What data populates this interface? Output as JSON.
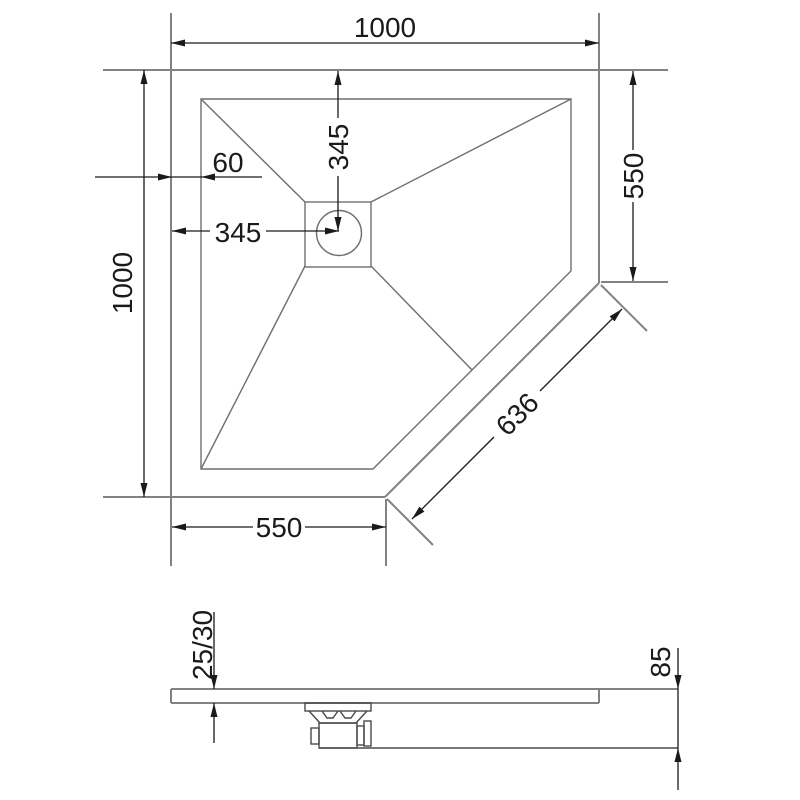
{
  "drawing": {
    "title": "corner shower tray dimension drawing",
    "colors": {
      "background": "#ffffff",
      "object_line": "#828282",
      "detail_line": "#4a4a4a",
      "dimension_line": "#1a1a1a"
    },
    "top_view": {
      "overall_width": "1000",
      "overall_depth": "1000",
      "rim_width": "60",
      "drain_center_from_left": "345",
      "drain_center_from_top": "345",
      "right_side_length": "550",
      "bottom_side_length": "550",
      "diagonal_length": "636"
    },
    "side_view": {
      "edge_thickness": "25/30",
      "overall_height": "85"
    }
  }
}
